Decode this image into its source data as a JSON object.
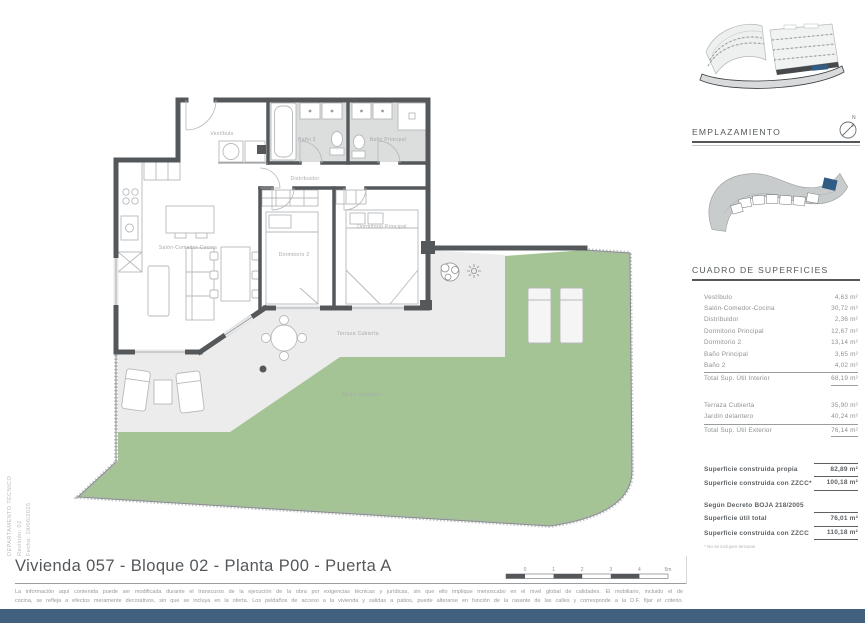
{
  "page": {
    "title": "Vivienda 057 - Bloque 02 - Planta P00 - Puerta A",
    "disclaimer_line1": "La información aquí contenida puede  ser modificada durante el transcurso de la ejecución de la obra por exigencias técnicas y jurídicas,  sin  que  ello  implique  menoscabo  en el nivel global de calidades.  El  mobiliario, incluido el de",
    "disclaimer_line2": "cocina, se refleja a efectos meramente decorativos, sin que se incluya en la oferta. Los peldaños de acceso a la vivienda y  salidas  a patios,  puede alterarse  en función de la rasante de las calles y corresponde a  la  D.F.  fijar el criterio.",
    "footer_color": "#40607d"
  },
  "side_note": {
    "department": "DEPARTAMENTO TÉCNICO",
    "revision": "Revisión: 02",
    "date": "Fecha: 19/06/2025"
  },
  "plan": {
    "labels": {
      "vestibulo": "Vestíbulo",
      "bano2": "Baño 2",
      "bano_principal": "Baño Principal",
      "distribuidor": "Distribuidor",
      "salon": "Salón-Comedor-Cocina",
      "dormitorio2": "Dormitorio 2",
      "dormitorio_principal": "Dormitorio Principal",
      "terraza": "Terraza Cubierta",
      "jardin": "Jardín delantero"
    },
    "scale_ticks": [
      "0",
      "1",
      "2",
      "3",
      "4",
      "5m"
    ],
    "colors": {
      "wall": "#54585b",
      "terrace": "#ececec",
      "garden": "#a5c496",
      "bath_floor": "#dcdddd"
    }
  },
  "emplazamiento": {
    "heading": "EMPLAZAMIENTO",
    "compass_letter": "N",
    "highlight_color": "#2f5d85"
  },
  "surfaces": {
    "heading": "CUADRO DE SUPERFICIES",
    "interior_rows": [
      {
        "label": "Vestíbulo",
        "value": "4,63 m²"
      },
      {
        "label": "Salón-Comedor-Cocina",
        "value": "30,72 m²"
      },
      {
        "label": "Distribuidor",
        "value": "2,36 m²"
      },
      {
        "label": "Dormitorio Principal",
        "value": "12,67 m²"
      },
      {
        "label": "Dormitorio 2",
        "value": "13,14 m²"
      },
      {
        "label": "Baño Principal",
        "value": "3,65 m²"
      },
      {
        "label": "Baño 2",
        "value": "4,02 m²"
      }
    ],
    "interior_total": {
      "label": "Total Sup. Útil Interior",
      "value": "68,19 m²"
    },
    "exterior_rows": [
      {
        "label": "Terraza Cubierta",
        "value": "35,90 m²"
      },
      {
        "label": "Jardín delantero",
        "value": "40,24 m²"
      }
    ],
    "exterior_total": {
      "label": "Total Sup. Útil Exterior",
      "value": "76,14 m²"
    },
    "built_rows": [
      {
        "label": "Superficie construida propia",
        "value": "82,89 m²"
      },
      {
        "label": "Superficie construida con ZZCC*",
        "value": "100,18 m²"
      }
    ],
    "decree_heading": "Según Decreto BOJA 218/2005",
    "decree_rows": [
      {
        "label": "Superficie útil total",
        "value": "76,01 m²"
      },
      {
        "label": "Superficie construida con ZZCC",
        "value": "110,18 m²"
      }
    ],
    "footnote": "* No se incluyen terrazas"
  }
}
